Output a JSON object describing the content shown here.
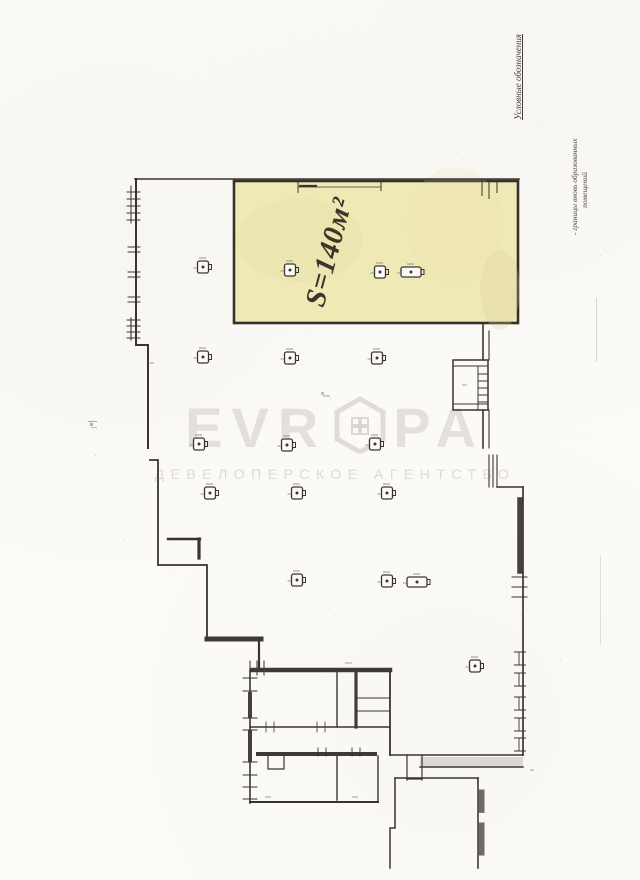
{
  "page": {
    "background": "#fcfbf8"
  },
  "legend": {
    "title": "Условные обозначения",
    "note_line1": "- границы вновь образованных",
    "note_line2": "помещений"
  },
  "highlight": {
    "area_label": "S=140м²",
    "color": "#efe9b6"
  },
  "watermark": {
    "brand_left": "EVR",
    "brand_right": "PA",
    "subtitle": "ДЕВЕЛОПЕРСКОЕ АГЕНТСТВО"
  },
  "plan": {
    "columns": [
      {
        "x": 203,
        "y": 267,
        "t": "sq"
      },
      {
        "x": 290,
        "y": 270,
        "t": "sq"
      },
      {
        "x": 380,
        "y": 272,
        "t": "sq"
      },
      {
        "x": 411,
        "y": 272,
        "t": "wide"
      },
      {
        "x": 203,
        "y": 357,
        "t": "sq"
      },
      {
        "x": 290,
        "y": 358,
        "t": "sq"
      },
      {
        "x": 377,
        "y": 358,
        "t": "sq"
      },
      {
        "x": 199,
        "y": 444,
        "t": "sq"
      },
      {
        "x": 287,
        "y": 445,
        "t": "sq"
      },
      {
        "x": 375,
        "y": 444,
        "t": "sq"
      },
      {
        "x": 210,
        "y": 493,
        "t": "sq"
      },
      {
        "x": 297,
        "y": 493,
        "t": "sq"
      },
      {
        "x": 387,
        "y": 493,
        "t": "sq"
      },
      {
        "x": 297,
        "y": 580,
        "t": "sq"
      },
      {
        "x": 387,
        "y": 581,
        "t": "sq"
      },
      {
        "x": 417,
        "y": 582,
        "t": "wide"
      },
      {
        "x": 475,
        "y": 666,
        "t": "sq"
      }
    ]
  }
}
